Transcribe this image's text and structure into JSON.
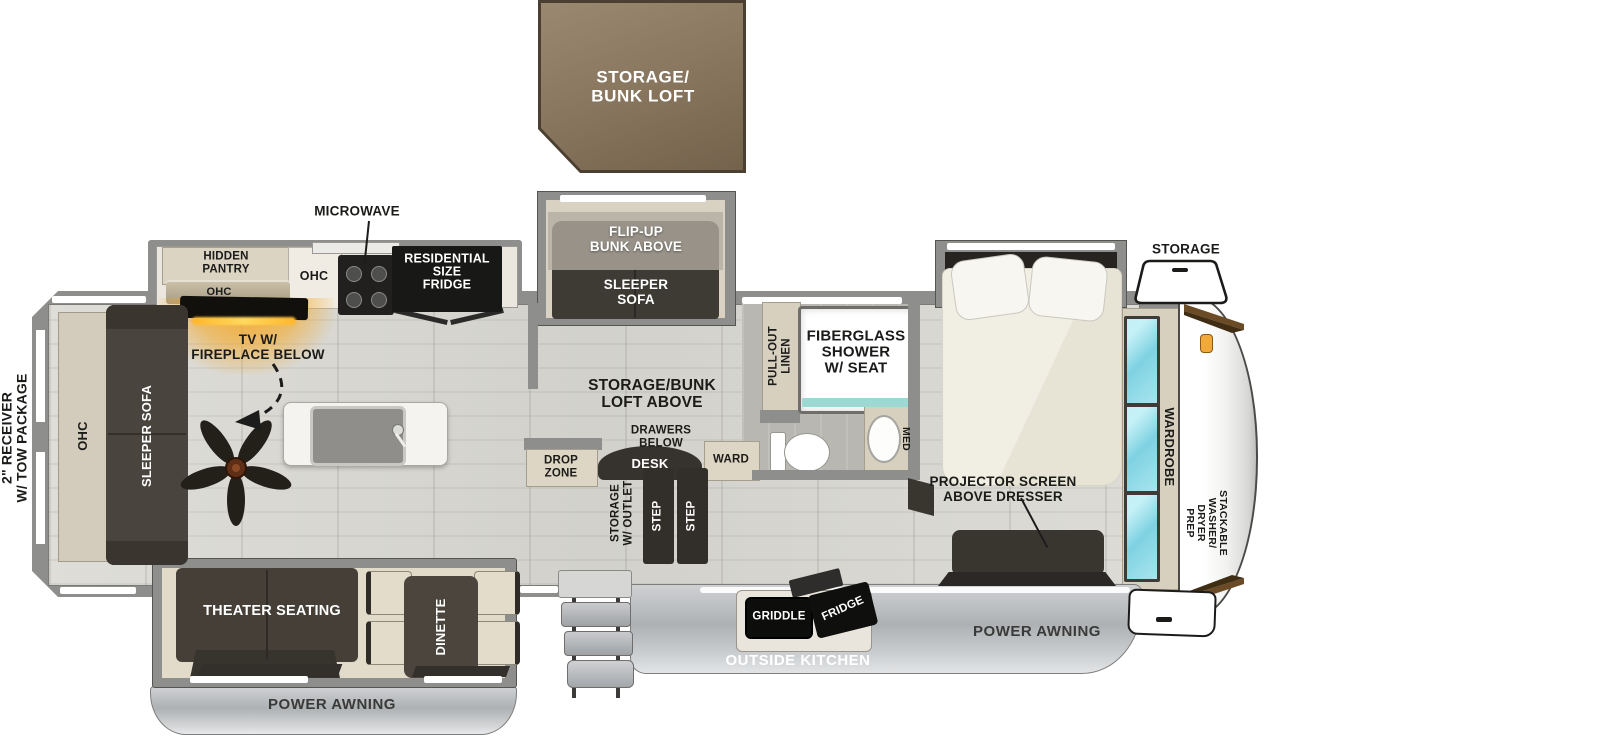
{
  "title": "Fifth Wheel RV Floorplan",
  "colors": {
    "loft_brown": "#8a7860",
    "wall_gray": "#8e8e8c",
    "floor": "#d9d8d3",
    "cabinet_tan": "#d9d1c0",
    "furniture_dark": "#453f39",
    "mirror_teal": "#8fd9e6",
    "fireplace_orange": "#f5a21e",
    "awning_gray": "#c0c3c6",
    "text_dark": "#1b1b19",
    "text_light": "#ffffff"
  },
  "loft": {
    "label": "STORAGE/\nBUNK LOFT"
  },
  "exterior": {
    "receiver": "2\" RECEIVER\nW/ TOW PACKAGE",
    "storage_hatch": "STORAGE",
    "power_awning_left": "POWER AWNING",
    "power_awning_right": "POWER AWNING",
    "outside_kitchen": "OUTSIDE KITCHEN",
    "griddle": "GRIDDLE",
    "fridge": "FRIDGE"
  },
  "kitchen": {
    "microwave": "MICROWAVE",
    "hidden_pantry": "HIDDEN\nPANTRY",
    "pantry_ohc": "OHC",
    "kitchen_ohc": "OHC",
    "residential_fridge": "RESIDENTIAL\nSIZE\nFRIDGE"
  },
  "living": {
    "tv_fireplace": "TV W/\nFIREPLACE BELOW",
    "rear_ohc": "OHC",
    "rear_sleeper_sofa": "SLEEPER SOFA",
    "flip_up_bunk": "FLIP-UP\nBUNK ABOVE",
    "slide_sleeper_sofa": "SLEEPER\nSOFA",
    "loft_above": "STORAGE/BUNK\nLOFT ABOVE",
    "drawers_below": "DRAWERS\nBELOW",
    "desk": "DESK",
    "drop_zone": "DROP\nZONE",
    "ward": "WARD",
    "storage_outlet": "STORAGE\nW/ OUTLET",
    "step_a": "STEP",
    "step_b": "STEP",
    "theater_seating": "THEATER SEATING",
    "dinette": "DINETTE"
  },
  "bath": {
    "pull_out_linen": "PULL-OUT\nLINEN",
    "shower": "FIBERGLASS\nSHOWER\nW/ SEAT",
    "med": "MED"
  },
  "bedroom": {
    "projector": "PROJECTOR SCREEN\nABOVE DRESSER",
    "wardrobe": "WARDROBE",
    "washer_prep": "STACKABLE\nWASHER/\nDRYER\nPREP"
  }
}
